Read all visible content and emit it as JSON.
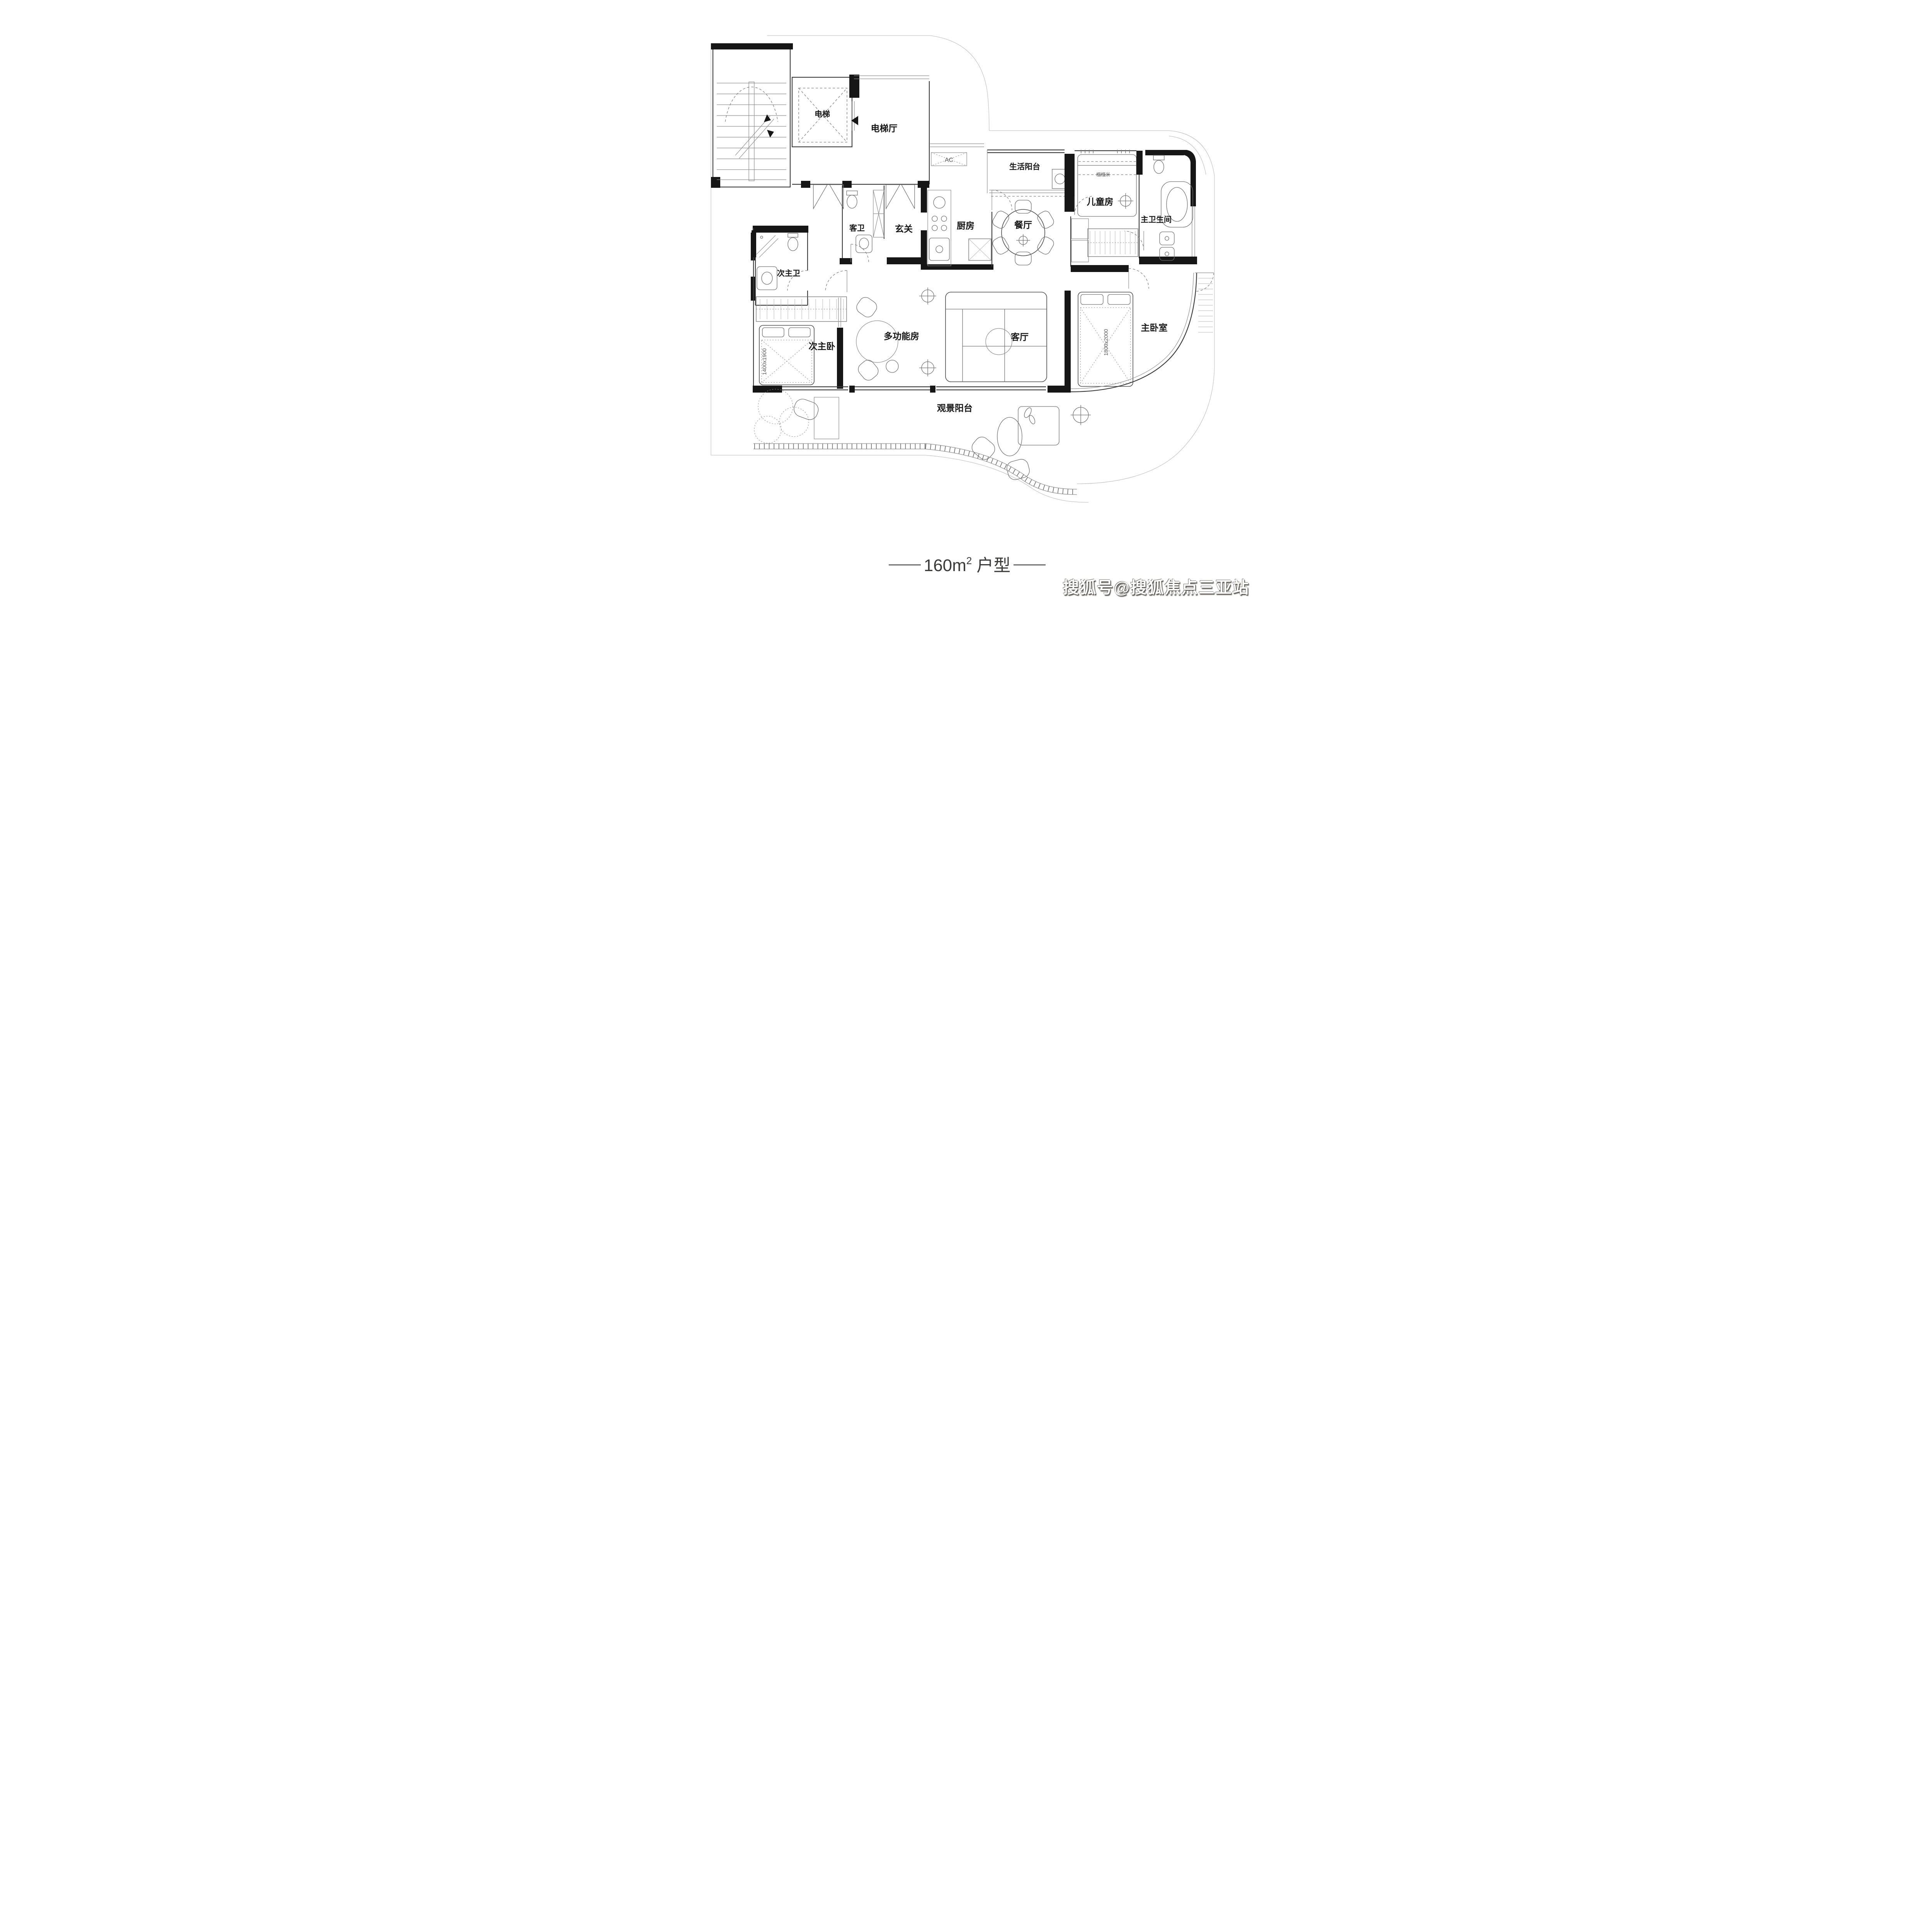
{
  "title": {
    "main": "160m",
    "sup": "2",
    "suffix": "户型"
  },
  "watermark": {
    "text": "搜狐号@搜狐焦点三亚站"
  },
  "rooms": {
    "elevator": {
      "label": "电梯"
    },
    "elevator_hall": {
      "label": "电梯厅"
    },
    "life_balcony": {
      "label": "生活阳台"
    },
    "children_room": {
      "label": "儿童房",
      "note": "榻榻米"
    },
    "master_bathroom": {
      "label": "主卫生间"
    },
    "guest_bathroom": {
      "label": "客卫"
    },
    "entryway": {
      "label": "玄关"
    },
    "kitchen": {
      "label": "厨房"
    },
    "dining_room": {
      "label": "餐厅"
    },
    "secondary_master_bathroom": {
      "label": "次主卫"
    },
    "secondary_master_bedroom": {
      "label": "次主卧",
      "bed_size": "1400x1900"
    },
    "multifunction_room": {
      "label": "多功能房"
    },
    "living_room": {
      "label": "客厅"
    },
    "master_bedroom": {
      "label": "主卧室",
      "bed_size": "1800x2000"
    },
    "viewing_balcony": {
      "label": "观景阳台"
    }
  },
  "annotations": {
    "ac": "AC"
  },
  "colors": {
    "wall": "#161616",
    "line": "#3c3c3c",
    "light_line": "#8b8b8b",
    "label_text": "#161616",
    "background": "#ffffff",
    "watermark_text": "#ffffff",
    "watermark_shadow": "#55524b"
  }
}
